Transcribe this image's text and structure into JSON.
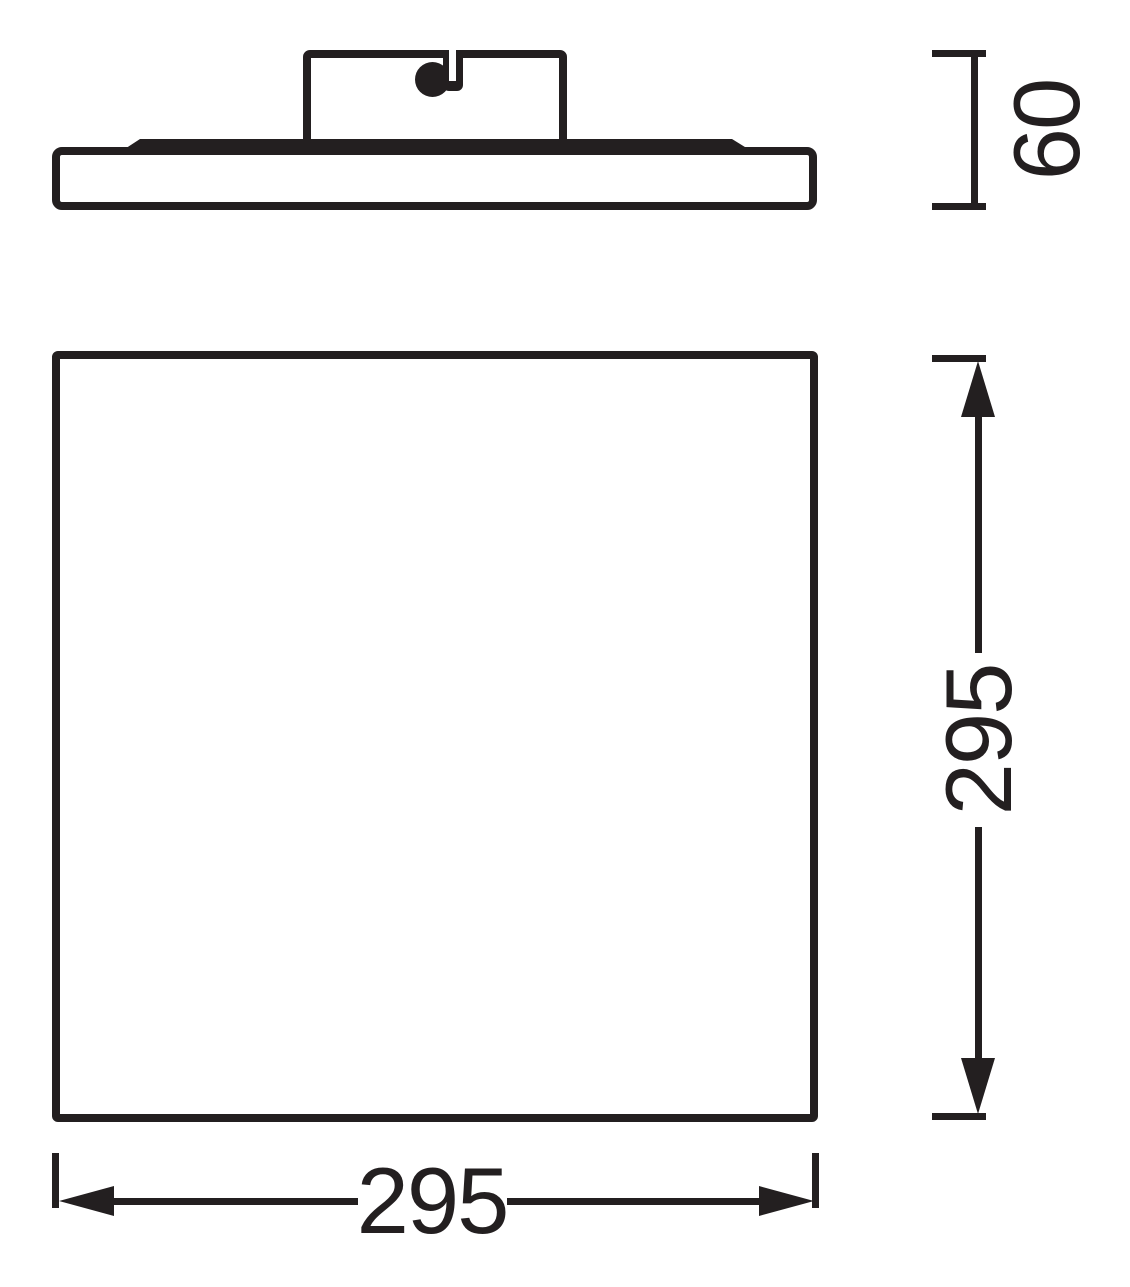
{
  "page": {
    "background_color": "#ffffff",
    "ink_color": "#231f20"
  },
  "drawing": {
    "type": "technical-dimension-drawing",
    "subject": "ceiling-panel-luminaire",
    "views": [
      {
        "id": "side_profile",
        "parts": [
          "mounting-box",
          "cable-entry",
          "frame-lip",
          "panel-profile"
        ]
      },
      {
        "id": "front_face",
        "parts": [
          "panel-face"
        ]
      }
    ],
    "dimensions": {
      "height": {
        "label": "60",
        "orientation": "vertical",
        "text_rotation_deg": -90,
        "style": "end-caps"
      },
      "side_length": {
        "label": "295",
        "orientation": "vertical",
        "text_rotation_deg": -90,
        "style": "arrows-with-end-ticks"
      },
      "width": {
        "label": "295",
        "orientation": "horizontal",
        "text_rotation_deg": 0,
        "style": "arrows-with-end-ticks"
      }
    }
  }
}
